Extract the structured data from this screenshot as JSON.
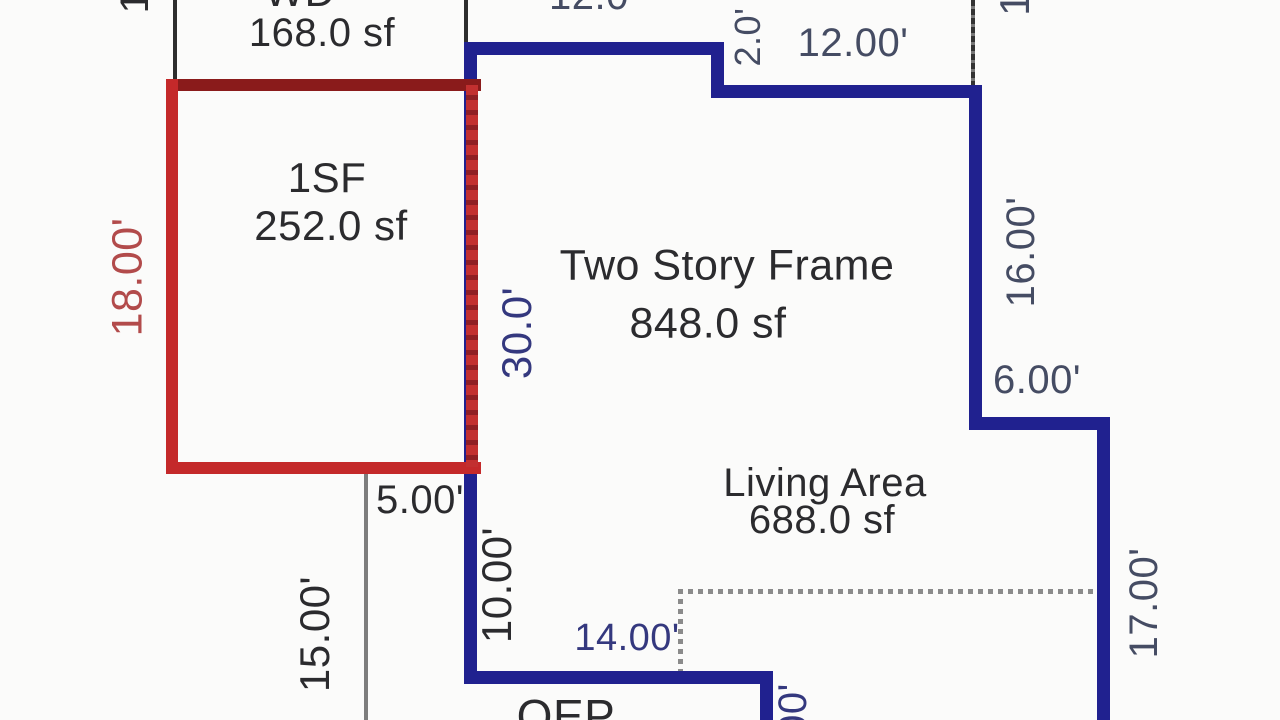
{
  "diagram": {
    "type": "appraisal-floor-plan-sketch",
    "rooms": {
      "wd": {
        "label": "WD",
        "area": "168.0 sf"
      },
      "one_story": {
        "label": "1SF",
        "area": "252.0 sf"
      },
      "two_story": {
        "label": "Two Story Frame",
        "area": "848.0 sf"
      },
      "living": {
        "label": "Living Area",
        "area": "688.0 sf"
      },
      "porch": {
        "label": "OEP"
      }
    },
    "dimensions": {
      "top_width": "12.0'",
      "top_jog": "2.0'",
      "top_right_width": "12.00'",
      "right_upper": "16.00'",
      "right_jog": "6.00'",
      "right_lower": "17.00'",
      "left_addition_height": "18.00'",
      "left_main_height": "30.0'",
      "bottom_left_offset": "5.00'",
      "left_lower": "10.00'",
      "left_porch_height": "15.00'",
      "bottom_width": "14.00'",
      "bottom_right_partial": "00'",
      "top_left_partial": "1",
      "top_right_partial": "1"
    },
    "colors": {
      "outline_blue": "#20218f",
      "outline_red": "#c4292a",
      "overlap_maroon": "#8f1f24",
      "dim_text_slate": "#454c63",
      "dim_text_indigo": "#34387e",
      "dim_text_red": "#b24b4b",
      "label_black": "#2b2b2e",
      "extension_gray": "#7d7d7d"
    }
  }
}
